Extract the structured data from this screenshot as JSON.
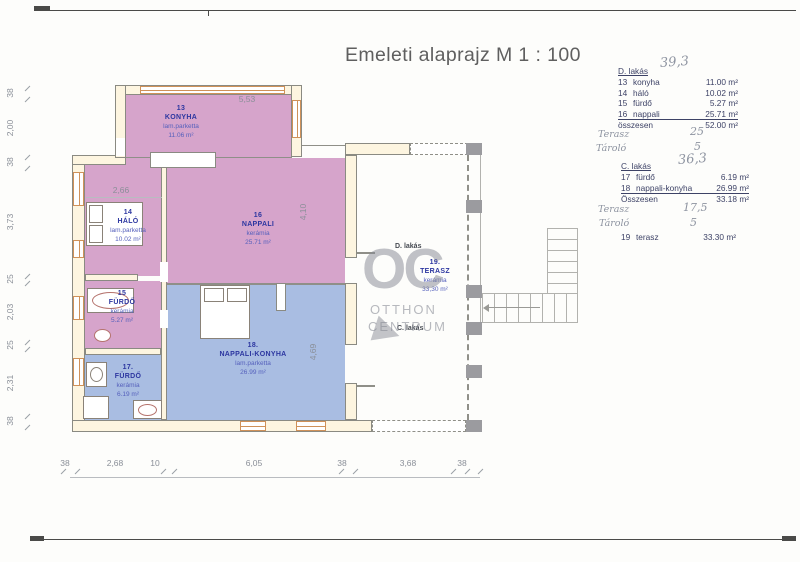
{
  "title": "Emeleti alaprajz M 1 : 100",
  "legend": {
    "d_flat": {
      "header": "D. lakás",
      "handwritten_total": "39,3",
      "rows": [
        {
          "num": "13",
          "name": "konyha",
          "area": "11.00 m²"
        },
        {
          "num": "14",
          "name": "háló",
          "area": "10.02 m²"
        },
        {
          "num": "15",
          "name": "fürdő",
          "area": "5.27 m²"
        },
        {
          "num": "16",
          "name": "nappali",
          "area": "25.71 m²"
        }
      ],
      "total_label": "összesen",
      "total_area": "52.00 m²",
      "hw_terasz_label": "Terasz",
      "hw_terasz_value": "25",
      "hw_tarolo_label": "Tároló",
      "hw_tarolo_value": "5"
    },
    "c_flat": {
      "header": "C. lakás",
      "handwritten_total": "36,3",
      "rows": [
        {
          "num": "17",
          "name": "fürdő",
          "area": "6.19 m²"
        },
        {
          "num": "18",
          "name": "nappali-konyha",
          "area": "26.99 m²"
        }
      ],
      "total_label": "Összesen",
      "total_area": "33.18 m²",
      "hw_terasz_label": "Terasz",
      "hw_terasz_value": "17,5",
      "hw_tarolo_label": "Tároló",
      "hw_tarolo_value": "5"
    },
    "terasz_row": {
      "num": "19",
      "name": "terasz",
      "area": "33.30 m²"
    }
  },
  "rooms": {
    "konyha": {
      "num": "13",
      "name": "KONYHA",
      "floor": "lam.parketta",
      "area": "11.06 m²"
    },
    "halo": {
      "num": "14",
      "name": "HÁLÓ",
      "floor": "lam.parketta",
      "area": "10.02 m²"
    },
    "nappali": {
      "num": "16",
      "name": "NAPPALI",
      "floor": "kerámia",
      "area": "25.71 m²"
    },
    "furdo15": {
      "num": "15",
      "name": "FÜRDŐ",
      "floor": "kerámia",
      "area": "5.27 m²"
    },
    "furdo17": {
      "num": "17.",
      "name": "FÜRDŐ",
      "floor": "kerámia",
      "area": "6.19 m²"
    },
    "nappali_konyha": {
      "num": "18.",
      "name": "NAPPALI-KONYHA",
      "floor": "lam.parketta",
      "area": "26.99 m²"
    },
    "terasz": {
      "num": "19.",
      "name": "TERASZ",
      "floor": "kerámia",
      "area": "33,30 m²"
    }
  },
  "plan_labels": {
    "d_flat": "D. lakás",
    "c_flat": "C. lakás"
  },
  "watermark": {
    "logo": "OC",
    "line1": "OTTHON",
    "line2": "CENTRUM"
  },
  "dimensions": {
    "top_konyha": "5,53",
    "top_halo": "2,66",
    "nappali_height": "4,10",
    "nk_height": "4,69",
    "left": [
      "38",
      "2,00",
      "38",
      "3,73",
      "25",
      "2,03",
      "25",
      "2,31",
      "38"
    ],
    "bottom": [
      "38",
      "2,68",
      "10",
      "6,05",
      "38",
      "3,68",
      "38"
    ]
  },
  "colors": {
    "flat_d_fill": "#d6a4cb",
    "flat_c_fill": "#a9bde2",
    "wall_fill": "#fdf5e0",
    "window_accent": "#cf9159",
    "label_main": "#2c36a0",
    "label_sub": "#5560bc",
    "legend_text": "#3d4266",
    "handwriting": "#8d93a0",
    "dim_text": "#8a8f98",
    "watermark_gray": "#898c96"
  }
}
